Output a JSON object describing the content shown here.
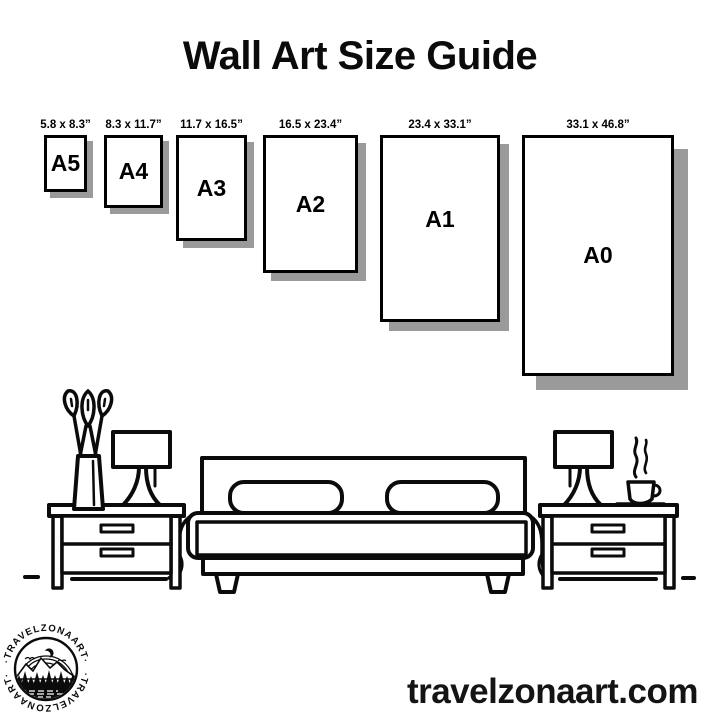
{
  "title": "Wall Art Size Guide",
  "sizes": [
    {
      "label": "A5",
      "dimensions": "5.8 x 8.3”"
    },
    {
      "label": "A4",
      "dimensions": "8.3 x 11.7”"
    },
    {
      "label": "A3",
      "dimensions": "11.7 x 16.5”"
    },
    {
      "label": "A2",
      "dimensions": "16.5 x 23.4”"
    },
    {
      "label": "A1",
      "dimensions": "23.4 x 33.1”"
    },
    {
      "label": "A0",
      "dimensions": "33.1 x 46.8”"
    }
  ],
  "brand": {
    "website": "travelzonaart.com",
    "logo_ring_text": "·TRAVELZONAART·"
  },
  "colors": {
    "ink": "#000000",
    "paper": "#ffffff",
    "shadow": "#9a9a9a"
  }
}
